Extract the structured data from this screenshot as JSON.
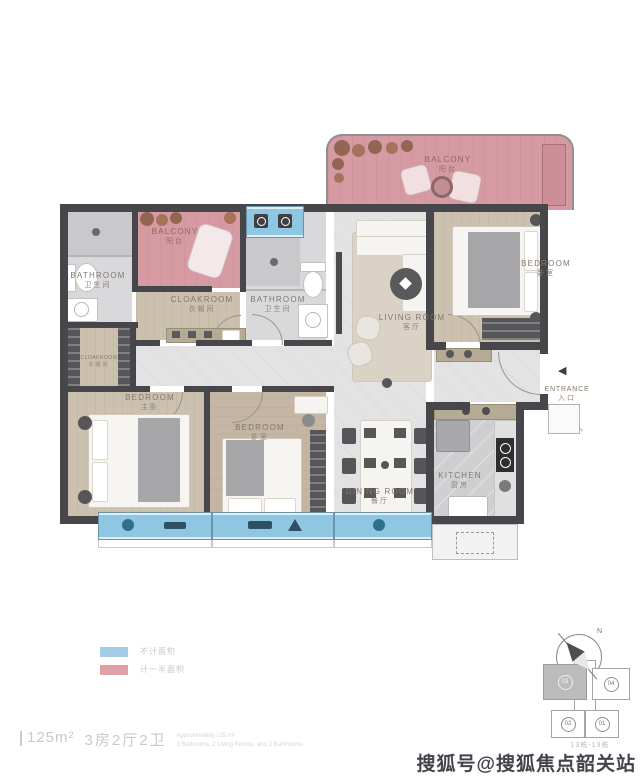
{
  "plan": {
    "rooms": {
      "balcony_top": {
        "label": "BALCONY",
        "cn": "阳台"
      },
      "balcony_left": {
        "label": "BALCONY",
        "cn": "阳台"
      },
      "bathroom_left": {
        "label": "BATHROOM",
        "cn": "卫生间"
      },
      "bathroom_mid": {
        "label": "BATHROOM",
        "cn": "卫生间"
      },
      "cloakroom_mid": {
        "label": "CLOAKROOM",
        "cn": "衣帽间"
      },
      "cloakroom_left": {
        "label": "CLOAKROOM",
        "cn": "衣帽间"
      },
      "living": {
        "label": "LIVING ROOM",
        "cn": "客厅"
      },
      "dining": {
        "label": "DINING ROOM",
        "cn": "餐厅"
      },
      "kitchen": {
        "label": "KITCHEN",
        "cn": "厨房"
      },
      "bedroom_right": {
        "label": "BEDROOM",
        "cn": "卧室"
      },
      "bedroom_left": {
        "label": "BEDROOM",
        "cn": "主卧"
      },
      "bedroom_mid": {
        "label": "BEDROOM",
        "cn": "卧室"
      },
      "entrance": {
        "label": "ENTRANCE",
        "cn": "入口",
        "arrow": "◀"
      }
    },
    "colors": {
      "wall": "#46464b",
      "balcony_pink": "#d69aa2",
      "window_blue": "#8fc7e3",
      "wood_floor": "#ccc0ae",
      "tile_floor": "#e3e3e4",
      "kitchen_floor": "#cfcfd1"
    }
  },
  "legend": {
    "items": [
      {
        "label": "不计面积",
        "color": "#a3cce6"
      },
      {
        "label": "计一半面积",
        "color": "#dfa0a6"
      }
    ]
  },
  "summary": {
    "area": "125m²",
    "layout": "3房2厅2卫",
    "en_line1": "Approximately 125 m²",
    "en_line2": "3 Bedrooms, 2 Living Rooms, and 2 Bathrooms"
  },
  "compass": {
    "north": "N"
  },
  "keyplan": {
    "units": [
      {
        "no": "03",
        "current": true
      },
      {
        "no": "04",
        "current": false
      },
      {
        "no": "02",
        "current": false
      },
      {
        "no": "01",
        "current": false
      }
    ],
    "caption": "13栋-13栋"
  },
  "watermark": "搜狐号@搜狐焦点韶关站"
}
